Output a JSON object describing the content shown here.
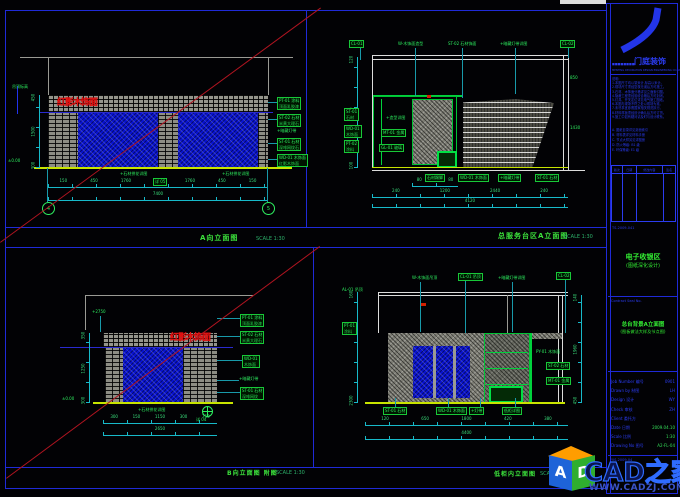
{
  "page": {
    "bg": "#020205",
    "frame_color": "#1f2ad8",
    "revision_line_color": "#b01420",
    "dim_color": "#17b9c9",
    "annotation_color": "#2ef060",
    "stone_blue": "#0913cf",
    "ground_line_color": "#c8e400"
  },
  "sheet": {
    "views": [
      {
        "id": "a",
        "title": "A向立面图",
        "scale": "SCALE 1:30"
      },
      {
        "id": "b",
        "title": "总服务台区A立面图",
        "scale": "SCALE 1:30"
      },
      {
        "id": "c",
        "title": "B向立面图 附图",
        "scale": "SCALE 1:30"
      },
      {
        "id": "d",
        "title": "低柜内立面图",
        "scale": "SCALE 1:30"
      }
    ]
  },
  "annotations": {
    "a": [
      {
        "t": "red",
        "x": 57,
        "y": 98,
        "text": "红影木饰面"
      },
      {
        "t": "box",
        "x": 277,
        "y": 97,
        "text": "PT-01 涂料",
        "sub": "顶面乳胶漆"
      },
      {
        "t": "box",
        "x": 277,
        "y": 114,
        "text": "ST-02 石材",
        "sub": "米黄大理石"
      },
      {
        "t": "txt",
        "x": 277,
        "y": 128,
        "text": "+暗藏灯带"
      },
      {
        "t": "box",
        "x": 277,
        "y": 138,
        "text": "ST-01 石材",
        "sub": "深啡网纹石"
      },
      {
        "t": "box",
        "x": 277,
        "y": 154,
        "text": "WD-01 木饰面",
        "sub": "红影木饰面"
      },
      {
        "t": "ldr",
        "x": 268,
        "y": 102,
        "w": 9,
        "h": 1
      },
      {
        "t": "ldr",
        "x": 268,
        "y": 119,
        "w": 9,
        "h": 1
      },
      {
        "t": "ldr",
        "x": 268,
        "y": 143,
        "w": 9,
        "h": 1
      },
      {
        "t": "ldr",
        "x": 268,
        "y": 159,
        "w": 9,
        "h": 1
      },
      {
        "t": "txt",
        "x": 120,
        "y": 171,
        "text": "+石材拼花详图"
      },
      {
        "t": "txt",
        "x": 222,
        "y": 171,
        "text": "+石材拼花详图"
      },
      {
        "t": "box",
        "x": 153,
        "y": 178,
        "text": "详 05"
      },
      {
        "t": "txt",
        "x": 12,
        "y": 84,
        "text": "吊顶标高"
      },
      {
        "t": "txt",
        "x": 8,
        "y": 158,
        "text": "±0.00"
      },
      {
        "t": "ldr",
        "x": 17,
        "y": 86,
        "w": 1,
        "h": 28,
        "c": "#2233ee"
      },
      {
        "t": "vdim",
        "x": 36,
        "y": 95,
        "h": 73,
        "labels": [
          "450",
          "1500",
          "300"
        ]
      },
      {
        "t": "hdim",
        "x": 48,
        "y": 184,
        "w": 220,
        "labels": [
          "150",
          "450",
          "1760",
          "450",
          "1760",
          "450",
          "150"
        ]
      },
      {
        "t": "hdim",
        "x": 48,
        "y": 197,
        "w": 220,
        "labels": [
          "7400"
        ]
      },
      {
        "t": "ldr",
        "x": 47,
        "y": 168,
        "w": 1,
        "h": 34
      },
      {
        "t": "ldr",
        "x": 267,
        "y": 168,
        "w": 1,
        "h": 34
      },
      {
        "t": "axis",
        "x": 42,
        "y": 202,
        "text": "4"
      },
      {
        "t": "axis",
        "x": 262,
        "y": 202,
        "text": "5"
      }
    ],
    "b": [
      {
        "t": "box",
        "x": 349,
        "y": 40,
        "text": "CL-01"
      },
      {
        "t": "txt",
        "x": 398,
        "y": 41,
        "text": "W-木饰面造型"
      },
      {
        "t": "txt",
        "x": 448,
        "y": 41,
        "text": "ST-02 石材饰面"
      },
      {
        "t": "txt",
        "x": 500,
        "y": 41,
        "text": "+暗藏灯带详图"
      },
      {
        "t": "box",
        "x": 560,
        "y": 40,
        "text": "CL-02"
      },
      {
        "t": "ldr",
        "x": 360,
        "y": 48,
        "w": 1,
        "h": 12
      },
      {
        "t": "ldr",
        "x": 415,
        "y": 48,
        "w": 1,
        "h": 48
      },
      {
        "t": "ldr",
        "x": 462,
        "y": 48,
        "w": 1,
        "h": 50
      },
      {
        "t": "ldr",
        "x": 515,
        "y": 48,
        "w": 1,
        "h": 46
      },
      {
        "t": "ldr",
        "x": 568,
        "y": 48,
        "w": 1,
        "h": 10
      },
      {
        "t": "box",
        "x": 344,
        "y": 108,
        "text": "ST-01",
        "sub": "石材"
      },
      {
        "t": "box",
        "x": 344,
        "y": 125,
        "text": "WD-01",
        "sub": "木饰面"
      },
      {
        "t": "box",
        "x": 344,
        "y": 140,
        "text": "PT-02",
        "sub": "涂料"
      },
      {
        "t": "txt",
        "x": 386,
        "y": 115,
        "text": "+造型详图"
      },
      {
        "t": "box",
        "x": 381,
        "y": 129,
        "text": "MT-01 金属"
      },
      {
        "t": "box",
        "x": 379,
        "y": 144,
        "text": "GL-01 玻璃"
      },
      {
        "t": "ldr",
        "x": 427,
        "y": 95,
        "w": 4,
        "h": 3,
        "c": "#d42000"
      },
      {
        "t": "box",
        "x": 425,
        "y": 174,
        "text": "石材踢脚"
      },
      {
        "t": "box",
        "x": 458,
        "y": 174,
        "text": "WD-01 木饰面"
      },
      {
        "t": "box",
        "x": 498,
        "y": 174,
        "text": "+暗藏灯带"
      },
      {
        "t": "box",
        "x": 535,
        "y": 174,
        "text": "ST-01 石材"
      },
      {
        "t": "vdim",
        "x": 354,
        "y": 57,
        "h": 111,
        "labels": [
          "120",
          "2280",
          "100"
        ]
      },
      {
        "t": "hdim",
        "x": 412,
        "y": 183,
        "w": 46,
        "labels": [
          "80",
          "450",
          "80"
        ]
      },
      {
        "t": "hdim",
        "x": 372,
        "y": 194,
        "w": 196,
        "labels": [
          "240",
          "1200",
          "2440",
          "240"
        ]
      },
      {
        "t": "hdim",
        "x": 372,
        "y": 204,
        "w": 196,
        "labels": [
          "4120"
        ]
      },
      {
        "t": "txt",
        "x": 570,
        "y": 75,
        "text": "850"
      },
      {
        "t": "txt",
        "x": 570,
        "y": 125,
        "text": "1430"
      }
    ],
    "c": [
      {
        "t": "red",
        "x": 170,
        "y": 333,
        "text": "红影木饰面"
      },
      {
        "t": "box",
        "x": 240,
        "y": 314,
        "text": "PT-01 涂料",
        "sub": "顶面乳胶漆"
      },
      {
        "t": "box",
        "x": 240,
        "y": 331,
        "text": "ST-02 石材",
        "sub": "米黄大理石"
      },
      {
        "t": "box",
        "x": 242,
        "y": 355,
        "text": "WD-01",
        "sub": "木饰面"
      },
      {
        "t": "txt",
        "x": 239,
        "y": 376,
        "text": "+暗藏灯带"
      },
      {
        "t": "box",
        "x": 240,
        "y": 387,
        "text": "ST-01 石材",
        "sub": "深啡网纹"
      },
      {
        "t": "ldr",
        "x": 217,
        "y": 318,
        "w": 23,
        "h": 1
      },
      {
        "t": "ldr",
        "x": 217,
        "y": 336,
        "w": 23,
        "h": 1
      },
      {
        "t": "ldr",
        "x": 217,
        "y": 360,
        "w": 25,
        "h": 1
      },
      {
        "t": "ldr",
        "x": 217,
        "y": 380,
        "w": 22,
        "h": 1
      },
      {
        "t": "ldr",
        "x": 217,
        "y": 392,
        "w": 23,
        "h": 1
      },
      {
        "t": "ldr",
        "x": 100,
        "y": 316,
        "w": 1,
        "h": 16
      },
      {
        "t": "txt",
        "x": 92,
        "y": 309,
        "text": "+2750"
      },
      {
        "t": "vdim",
        "x": 86,
        "y": 333,
        "h": 70,
        "labels": [
          "350",
          "1250",
          "300"
        ]
      },
      {
        "t": "txt",
        "x": 62,
        "y": 396,
        "text": "±0.00"
      },
      {
        "t": "txt",
        "x": 138,
        "y": 407,
        "text": "+石材拼花详图"
      },
      {
        "t": "callout",
        "x": 202,
        "y": 406
      },
      {
        "t": "txt",
        "x": 196,
        "y": 417,
        "text": "详 04"
      },
      {
        "t": "hdim",
        "x": 103,
        "y": 420,
        "w": 114,
        "labels": [
          "300",
          "150",
          "1150",
          "300",
          "750"
        ]
      },
      {
        "t": "hdim",
        "x": 103,
        "y": 432,
        "w": 114,
        "labels": [
          "2650"
        ]
      }
    ],
    "d": [
      {
        "t": "txt",
        "x": 412,
        "y": 275,
        "text": "W-木饰面吊顶"
      },
      {
        "t": "box",
        "x": 458,
        "y": 273,
        "text": "CL-01 吊顶"
      },
      {
        "t": "txt",
        "x": 498,
        "y": 275,
        "text": "+暗藏灯带详图"
      },
      {
        "t": "box",
        "x": 556,
        "y": 272,
        "text": "CL-02"
      },
      {
        "t": "txt",
        "x": 342,
        "y": 287,
        "text": "AL-01 吊顶"
      },
      {
        "t": "box",
        "x": 342,
        "y": 322,
        "text": "PT-01",
        "sub": "涂料"
      },
      {
        "t": "ldr",
        "x": 420,
        "y": 282,
        "w": 1,
        "h": 50
      },
      {
        "t": "ldr",
        "x": 465,
        "y": 281,
        "w": 1,
        "h": 52
      },
      {
        "t": "ldr",
        "x": 512,
        "y": 282,
        "w": 1,
        "h": 50
      },
      {
        "t": "ldr",
        "x": 565,
        "y": 280,
        "w": 1,
        "h": 53
      },
      {
        "t": "ldr",
        "x": 421,
        "y": 303,
        "w": 5,
        "h": 3,
        "c": "#d42000"
      },
      {
        "t": "txt",
        "x": 536,
        "y": 349,
        "text": "PY-01 木饰面"
      },
      {
        "t": "box",
        "x": 546,
        "y": 362,
        "text": "ST-02 石材"
      },
      {
        "t": "box",
        "x": 546,
        "y": 377,
        "text": "MT-01 金属"
      },
      {
        "t": "vdim",
        "x": 578,
        "y": 295,
        "h": 108,
        "labels": [
          "140",
          "1960",
          "450"
        ]
      },
      {
        "t": "vdim",
        "x": 354,
        "y": 292,
        "h": 111,
        "labels": [
          "160",
          "2300"
        ]
      },
      {
        "t": "box",
        "x": 383,
        "y": 407,
        "text": "ST-01 石材"
      },
      {
        "t": "box",
        "x": 436,
        "y": 407,
        "text": "WD-01 木饰面"
      },
      {
        "t": "box",
        "x": 469,
        "y": 407,
        "text": "+灯带"
      },
      {
        "t": "box",
        "x": 502,
        "y": 407,
        "text": "低柜详图"
      },
      {
        "t": "ldr",
        "x": 395,
        "y": 398,
        "w": 1,
        "h": 9
      },
      {
        "t": "ldr",
        "x": 448,
        "y": 398,
        "w": 1,
        "h": 9
      },
      {
        "t": "ldr",
        "x": 480,
        "y": 398,
        "w": 1,
        "h": 9
      },
      {
        "t": "ldr",
        "x": 515,
        "y": 398,
        "w": 1,
        "h": 9
      },
      {
        "t": "hdim",
        "x": 365,
        "y": 422,
        "w": 203,
        "labels": [
          "120",
          "650",
          "1800",
          "420",
          "380"
        ]
      },
      {
        "t": "hdim",
        "x": 365,
        "y": 436,
        "w": 203,
        "labels": [
          "4400"
        ]
      }
    ]
  },
  "title_block": {
    "logo_name": "门庭装饰",
    "logo_sub": "MENTING DECORATION DESIGN ENGINEERING CO.,LTD",
    "stamp_row": "■■■■■■■■",
    "notes": [
      "说明:",
      "1.本图尺寸均以毫米计,标高以米计。",
      "2.现场尺寸须经复核无误后方可施工。",
      "3.石材、木饰面分格详见立面索引图。",
      "4.隐蔽工程须经验收合格后方可封闭。",
      "5.灯具、开关定位详见电气施工图纸。",
      "6.本图与现场不符之处以现场为准。",
      "7.未尽事宜参照国家相关规范执行。",
      "8.材料样板须经设计确认后方可订货。",
      "9.施工中如有疑问请及时与设计联系。"
    ],
    "list_items": [
      "A. 图纸目录详见封面索引",
      "B. 材料表详见材料手册",
      "C. 节点大样另见详图册",
      "D. 防火等级: B1 级",
      "E. 环保等级: E1 级"
    ],
    "rev_headers": [
      "版次",
      "日期",
      "修改内容",
      "签名"
    ],
    "misc_no": "TS-2009-041",
    "project_title_line1": "电子收银区",
    "project_title_line2": "(图纸深化设计)",
    "seal_label": "Contract Seal No.",
    "drawing_title_line1": "总台背景A立面图",
    "drawing_title_line2": "(图板做法大样及节点图)",
    "fields": [
      {
        "label": "Job Number 编号",
        "value": "0901",
        "green": false
      },
      {
        "label": "Drawn by 制图",
        "value": "LH",
        "green": false
      },
      {
        "label": "Design 设计",
        "value": "WY",
        "green": false
      },
      {
        "label": "Check 审核",
        "value": "ZH",
        "green": false
      },
      {
        "label": "Client 委托方",
        "value": "",
        "green": false
      },
      {
        "label": "Date 日期",
        "value": "2009.04.10",
        "green": true
      },
      {
        "label": "Scale 比例",
        "value": "1:30",
        "green": true
      },
      {
        "label": "Drawing No 图号",
        "value": "A2-FL-04",
        "green": true
      }
    ],
    "footer_no": "YIS-2009-04"
  },
  "watermark": {
    "brand": "CAD之家",
    "url": "WWW.CADZJ.COM",
    "cube_front_letter": "A",
    "cube_side_letter": "D"
  }
}
